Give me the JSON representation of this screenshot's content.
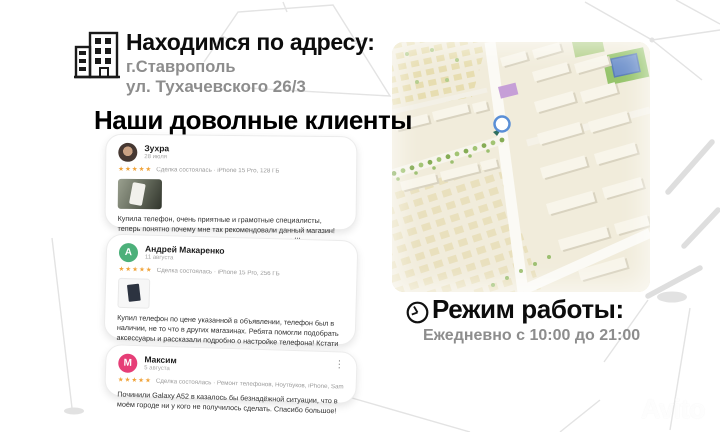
{
  "address": {
    "heading": "Находимся по адресу:",
    "city": "г.Ставрополь",
    "street": "ул. Тухачевского 26/3"
  },
  "reviews": {
    "heading": "Наши доволные клиенты",
    "items": [
      {
        "name": "Зухра",
        "date": "28 июля",
        "stars": "★★★★★",
        "deal": "Сделка состоялась · iPhone 15 Pro, 128 ГБ",
        "text": "Купила телефон, очень приятные и грамотные специалисты, теперь понятно почему мне так рекомендовали данный магазин! Сделали подарки и предложили самую лучшую цену!!!",
        "avatar": "photo"
      },
      {
        "name": "Андрей Макаренко",
        "date": "11 августа",
        "stars": "★★★★★",
        "deal": "Сделка состоялась · iPhone 15 Pro, 256 ГБ",
        "text": "Купил телефон по цене указанной в объявлении, телефон был в наличии, не то что в других магазинах. Ребята помогли подобрать аксессуары и рассказали подробно о настройке телефона! Кстати за перенос данных денег вообще не взяли, приду к ним еще раз обязательно!!!",
        "avatar_letter": "А",
        "avatar_color": "#4cb07a"
      },
      {
        "name": "Максим",
        "date": "5 августа",
        "stars": "★★★★★",
        "deal": "Сделка состоялась · Ремонт телефонов, Ноутбуков, iPhone, Samsung и т.д.",
        "text": "Починили Galaxy A52 в казалось бы безнадёжной ситуации, что в моём городе ни у кого не получилось сделать. Спасибо большое!",
        "avatar_letter": "М",
        "avatar_color": "#e63e77",
        "menu_icon": "⋮"
      }
    ]
  },
  "hours": {
    "heading": "Режим работы:",
    "schedule": "Ежедневно с 10:00 до 21:00"
  },
  "watermark": {
    "text": "Avito"
  },
  "colors": {
    "stars": "#f0a33a",
    "muted_text": "#8d8d8d",
    "map_ground": "#f1ecdb",
    "marker_blue": "#5a8fd6",
    "avatar_green": "#4cb07a",
    "avatar_pink": "#e63e77"
  }
}
